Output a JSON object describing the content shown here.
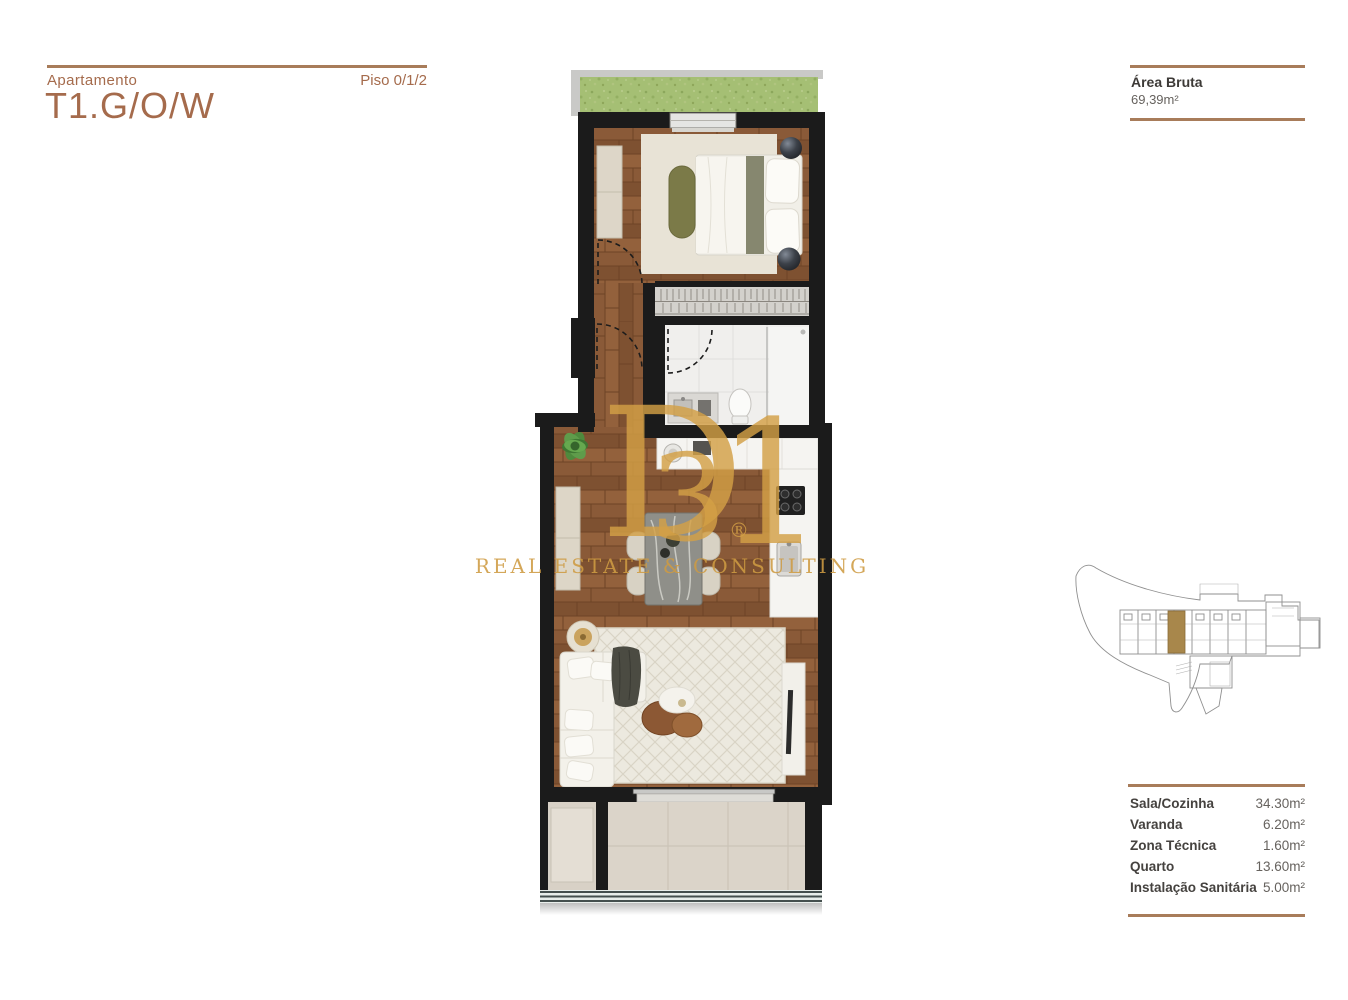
{
  "header": {
    "apartment_label": "Apartamento",
    "title": "T1.G/O/W",
    "floor": "Piso 0/1/2"
  },
  "gross_area": {
    "label": "Área Bruta",
    "value": "69,39m²"
  },
  "areas": {
    "rows": [
      {
        "label": "Sala/Cozinha",
        "value": "34.30m²"
      },
      {
        "label": "Varanda",
        "value": "6.20m²"
      },
      {
        "label": "Zona Técnica",
        "value": "1.60m²"
      },
      {
        "label": "Quarto",
        "value": "13.60m²"
      },
      {
        "label": "Instalação Sanitária",
        "value": "5.00m²"
      }
    ]
  },
  "watermark": {
    "letter_d": "D",
    "digit_3": "3",
    "digit_1": "1",
    "registered": "®",
    "slogan": "REAL ESTATE & CONSULTING"
  },
  "colors": {
    "accent_brown": "#a56b4c",
    "rule_brown": "#a87c5a",
    "watermark_gold": "#d3a046",
    "wall_black": "#1b1b1b",
    "wood_floor": "#8a5a38",
    "grass_green": "#a5bf74",
    "highlighted_unit": "#a8874b"
  }
}
